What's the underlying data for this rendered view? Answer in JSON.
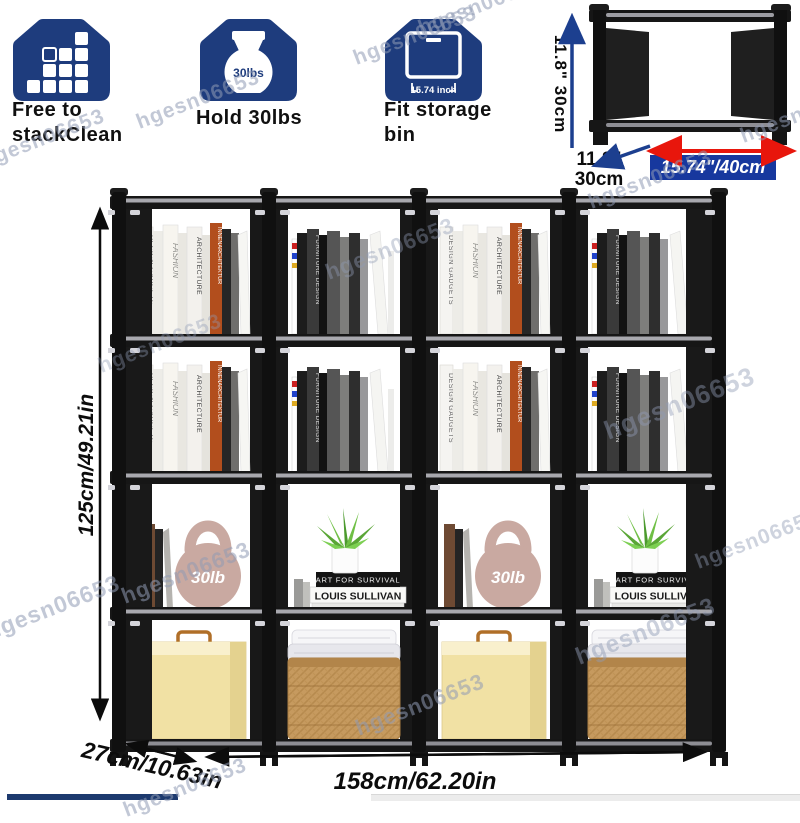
{
  "watermark": {
    "text": "hgesn06653"
  },
  "features": [
    {
      "line1": "Free to",
      "line2": "stackClean"
    },
    {
      "line1": "Hold 30lbs",
      "line2": "",
      "icon_text": "30lbs"
    },
    {
      "line1": "Fit storage",
      "line2": "bin",
      "icon_text": "15.74 inch"
    }
  ],
  "unit_diagram": {
    "side_label": "11.8\"   30cm",
    "depth_line1": "11.8\"",
    "depth_line2": "30cm",
    "width_label": "15.74\"/40cm"
  },
  "dimensions": {
    "height": "125cm/49.21in",
    "depth": "27cm/10.63in",
    "width": "158cm/62.20in"
  },
  "shelf": {
    "spine_design_gadgets": "DESIGN GADGETS",
    "spine_fashion": "FASHION",
    "spine_architecture": "ARCHITECTURE",
    "spine_innenarchitektur": "INNENARCHITEKTUR",
    "spine_furniture_design": "FURNITURE DESIGN",
    "stack_book_top": "ART FOR SURVIVAL",
    "stack_book_bottom": "LOUIS SULLIVAN",
    "kettlebell_label": "30lb"
  },
  "colors": {
    "brand_blue": "#1e3c7d",
    "arrow_blue": "#1c3f8f",
    "accent_red": "#e8160c",
    "label_box_blue": "#17389e",
    "bottom_bar_navy": "#1d3a6e"
  }
}
